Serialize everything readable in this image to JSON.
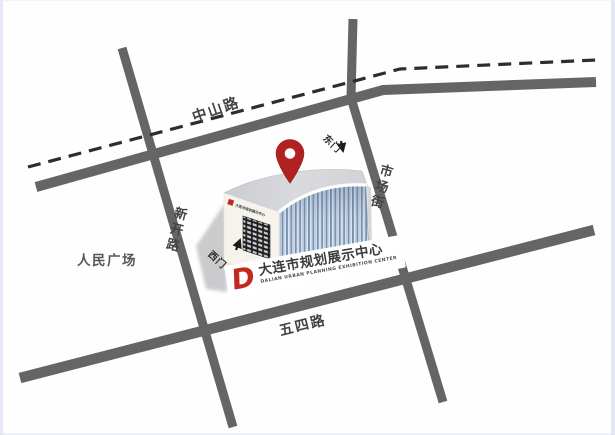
{
  "map": {
    "background": "#fefefe",
    "road_color": "#656565",
    "railway_color": "#2d2d2d"
  },
  "roads": {
    "zhongshan_label": "中山路",
    "shichang_label": "市场街",
    "xinkai_label": "新开路",
    "wusi_label": "五四路"
  },
  "landmarks": {
    "square_label": "人民广场",
    "east_gate_label": "东门",
    "west_gate_label": "西门"
  },
  "building": {
    "sign_text": "大连市规划展示中心",
    "pin_color": "#b0211f"
  },
  "logo": {
    "glyph": "D",
    "title_cn": "大连市规划展示中心",
    "title_en": "DALIAN URBAN PLANNING EXHIBITION CENTER",
    "accent": "#c2281e"
  }
}
